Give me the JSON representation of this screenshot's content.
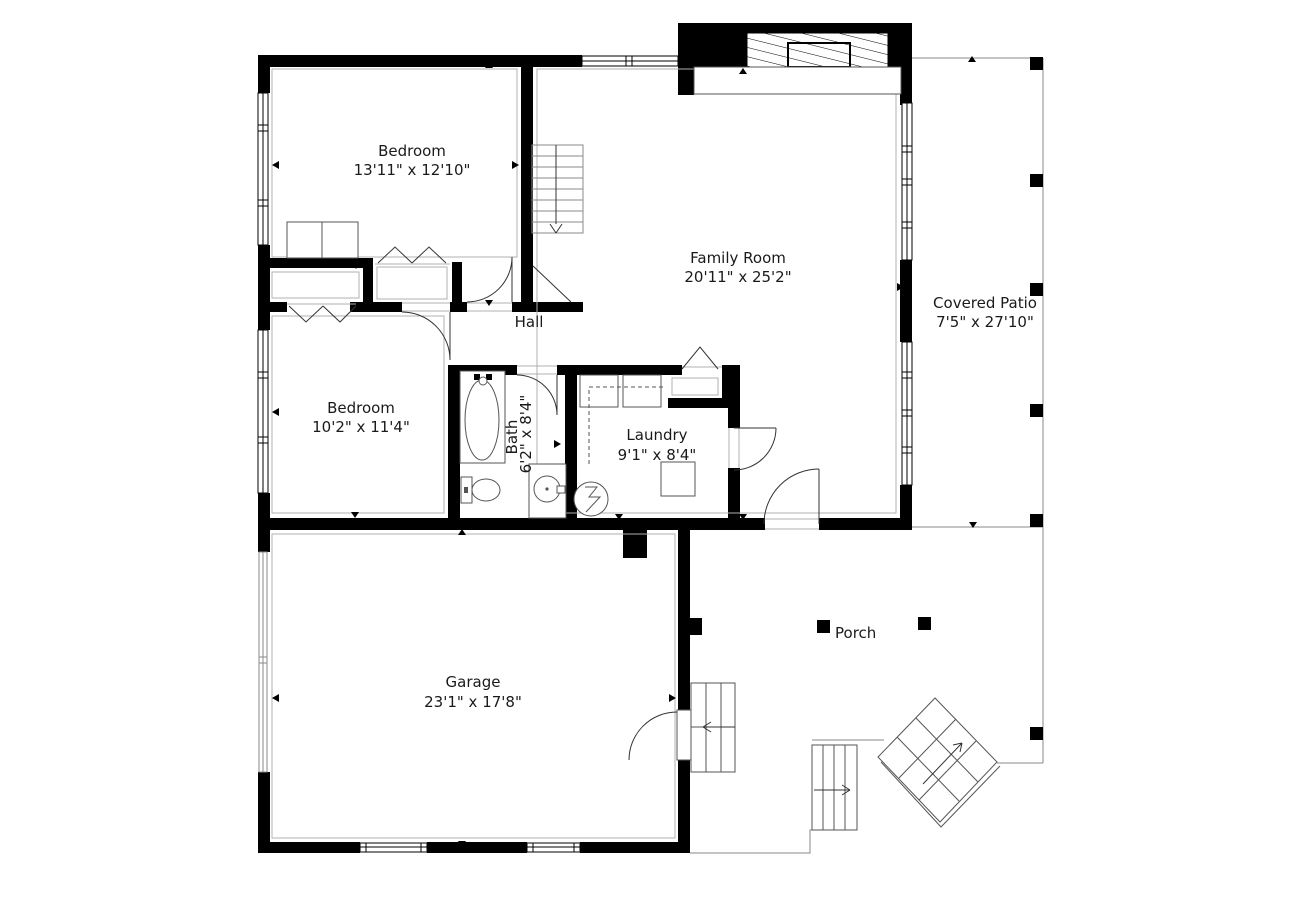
{
  "page": {
    "background": "#ffffff"
  },
  "colors": {
    "wall": "#000000",
    "line": "#555555",
    "light_line": "#b0b0b0",
    "text": "#1a1a1a"
  },
  "rooms": [
    {
      "id": "bedroom-1",
      "name": "Bedroom",
      "dims": "13'11\" x 12'10\""
    },
    {
      "id": "family-room",
      "name": "Family Room",
      "dims": "20'11\" x 25'2\""
    },
    {
      "id": "covered-patio",
      "name": "Covered Patio",
      "dims": "7'5\" x 27'10\""
    },
    {
      "id": "hall",
      "name": "Hall",
      "dims": ""
    },
    {
      "id": "bedroom-2",
      "name": "Bedroom",
      "dims": "10'2\" x 11'4\""
    },
    {
      "id": "bath",
      "name": "Bath",
      "dims": "6'2\" x 8'4\""
    },
    {
      "id": "laundry",
      "name": "Laundry",
      "dims": "9'1\" x 8'4\""
    },
    {
      "id": "garage",
      "name": "Garage",
      "dims": "23'1\" x 17'8\""
    },
    {
      "id": "porch",
      "name": "Porch",
      "dims": ""
    }
  ]
}
